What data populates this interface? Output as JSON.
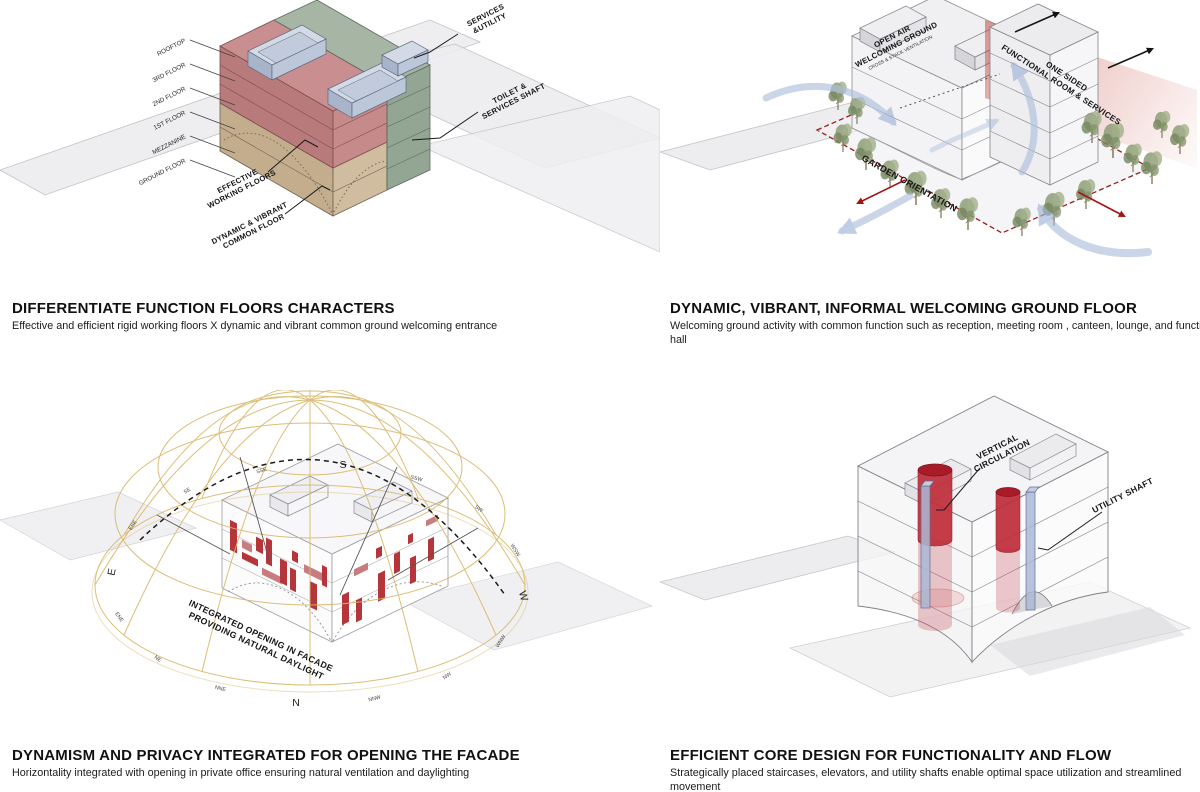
{
  "sheet": {
    "background": "#ffffff"
  },
  "panels": {
    "floors": {
      "title": "DIFFERENTIATE FUNCTION FLOORS CHARACTERS",
      "subtitle": "Effective and efficient rigid working floors X dynamic and vibrant common ground welcoming entrance",
      "floor_labels": [
        "ROOFTOP",
        "3RD FLOOR",
        "2ND FLOOR",
        "1ST FLOOR",
        "MEZZANINE",
        "GROUND FLOOR"
      ],
      "labels": {
        "services_utility": [
          "SERVICES",
          "&UTILITY"
        ],
        "toilet_shaft": [
          "TOILET &",
          "SERVICES SHAFT"
        ],
        "working_floors": [
          "EFFECTIVE",
          "WORKING FLOORS"
        ],
        "common_floor": [
          "DYNAMIC & VIBRANT",
          "COMMON FLOOR"
        ]
      },
      "colors": {
        "working_floors": "#bd7a78",
        "common_floor": "#c9b391",
        "services_shaft": "#93a593",
        "rooftop_units": "#b9c3d6"
      }
    },
    "ground": {
      "title": "DYNAMIC, VIBRANT, INFORMAL WELCOMING GROUND FLOOR",
      "subtitle": "Welcoming ground activity with common function such as reception, meeting room , canteen, lounge, and function hall",
      "labels": {
        "open_air": [
          "OPEN AIR",
          "WELCOMING GROUND"
        ],
        "ventilation": "CROSS & STACK VENTILATION",
        "one_sided": [
          "ONE SIDED",
          "FUNCTIONAL ROOM & SERVICES"
        ],
        "garden": "GARDEN ORIENTATION"
      },
      "colors": {
        "airflow": "#aebfdd",
        "garden_boundary": "#9b1c1c",
        "functional_plane": "#c0392b",
        "trees": "#8d9d77"
      }
    },
    "facade": {
      "title": "DYNAMISM AND PRIVACY INTEGRATED FOR OPENING THE FACADE",
      "subtitle": "Horizontality integrated with opening in private office ensuring natural ventilation and daylighting",
      "labels": {
        "opening": [
          "INTEGRATED OPENING IN FACADE",
          "PROVIDING NATURAL DAYLIGHT"
        ]
      },
      "compass": {
        "cardinal": [
          "S",
          "N",
          "E",
          "W"
        ],
        "bearings": [
          "SSE",
          "SE",
          "ESE",
          "ENE",
          "NE",
          "NNE",
          "SSW",
          "SW",
          "WSW",
          "WNW",
          "NW",
          "NNW"
        ]
      },
      "colors": {
        "sun_dome": "#d8b76a",
        "openings": "#b6353a"
      }
    },
    "core": {
      "title": "EFFICIENT CORE DESIGN FOR FUNCTIONALITY AND FLOW",
      "subtitle": "Strategically placed staircases, elevators, and utility shafts enable optimal space utilization and streamlined movement",
      "labels": {
        "vertical": [
          "VERTICAL",
          "CIRCULATION"
        ],
        "utility": "UTILITY SHAFT"
      },
      "colors": {
        "circulation": "#b5212e",
        "utility_shaft": "#aab9d4"
      }
    }
  }
}
